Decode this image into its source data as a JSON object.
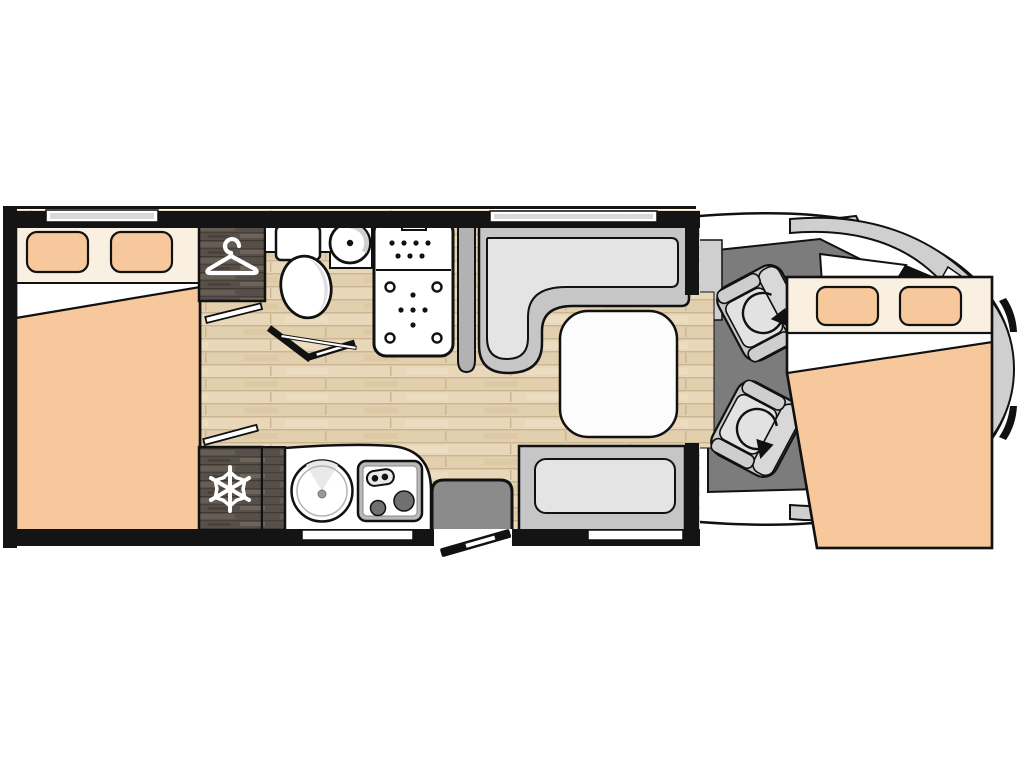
{
  "figure": {
    "kind": "motorhome-floorplan-top-view",
    "visible_text": []
  },
  "colors": {
    "background": "#ffffff",
    "outline": "#111111",
    "wall_black": "#141414",
    "bedding_peach": "#f6c89c",
    "bedding_cream": "#faf0e2",
    "mattress_white": "#ffffff",
    "floor_wood": "#e8d7b8",
    "floor_wood_seam": "#c9b591",
    "cabinet_dark_wood": "#57504a",
    "cab_floor_gray": "#7c7c7c",
    "bench_frame_gray": "#c6c6c6",
    "bench_cushion_gray": "#e4e4e4",
    "table_white": "#fcfcfc",
    "step_gray": "#8a8a8a",
    "body_panel_gray": "#cfcfcf",
    "body_white": "#ffffff",
    "appliance_gray": "#b9b9b9",
    "burner_gray": "#707070",
    "window_inner_gray": "#d9d9d9",
    "seat_base_gray": "#c7c7c7",
    "seat_cushion_gray": "#e2e2e2",
    "icon_white": "#ffffff"
  },
  "icons": {
    "wardrobe": "hanger-icon",
    "refrigerator": "snowflake-icon",
    "cab_seats": "swivel-rotation-arrow-icon",
    "kitchen": "sink-and-two-burner-hob",
    "bathroom": "toilet-and-round-basin",
    "shower": "shower-tray-with-drain-dots"
  },
  "areas": [
    "rear-double-bed",
    "wardrobe",
    "refrigerator",
    "bathroom",
    "shower-cubicle",
    "kitchen-block",
    "entry-step",
    "entry-door",
    "l-shaped-dinette-bench",
    "side-bench-seat",
    "dinette-table",
    "driver-swivel-seat",
    "passenger-swivel-seat",
    "front-drop-down-bed",
    "cab-with-vehicle-nose"
  ]
}
